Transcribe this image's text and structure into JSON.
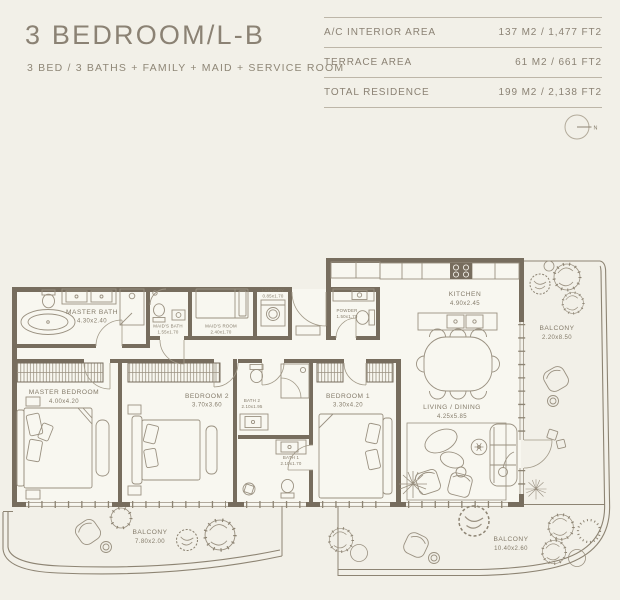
{
  "colors": {
    "background": "#f2f0e8",
    "wall": "#776d5e",
    "accent_text": "#8b8274",
    "table_line": "#bdb6a8"
  },
  "header": {
    "title": "3 BEDROOM/L-B",
    "subtitle": "3 BED / 3 BATHS + FAMILY + MAID + SERVICE ROOM"
  },
  "area_table": {
    "rows": [
      {
        "label": "A/C INTERIOR AREA",
        "value": "137 M2 / 1,477 FT2"
      },
      {
        "label": "TERRACE AREA",
        "value": "61 M2 / 661 FT2"
      },
      {
        "label": "TOTAL RESIDENCE",
        "value": "199 M2 / 2,138 FT2"
      }
    ]
  },
  "compass": {
    "label": "N"
  },
  "floorplan": {
    "rooms": [
      {
        "name": "MASTER BATH",
        "dims": "4.30x2.40"
      },
      {
        "name": "MAID'S BATH",
        "dims": "1.55x1.70"
      },
      {
        "name": "MAID'S ROOM",
        "dims": "2.40x1.70"
      },
      {
        "name": "LAUNDRY",
        "dims": "0.85x1.70"
      },
      {
        "name": "POWDER",
        "dims": "1.50x1.70"
      },
      {
        "name": "KITCHEN",
        "dims": "4.90x2.45"
      },
      {
        "name": "LIVING / DINING",
        "dims": "4.25x5.85"
      },
      {
        "name": "MASTER BEDROOM",
        "dims": "4.00x4.20"
      },
      {
        "name": "BEDROOM 2",
        "dims": "3.70x3.60"
      },
      {
        "name": "BEDROOM 1",
        "dims": "3.30x4.20"
      },
      {
        "name": "BATH 2",
        "dims": "2.10x1.95"
      },
      {
        "name": "BATH 1",
        "dims": "2.10x1.70"
      },
      {
        "name": "BALCONY",
        "dims": "2.20x8.50"
      },
      {
        "name": "BALCONY",
        "dims": "7.80x2.00"
      },
      {
        "name": "BALCONY",
        "dims": "10.40x2.60"
      }
    ]
  }
}
